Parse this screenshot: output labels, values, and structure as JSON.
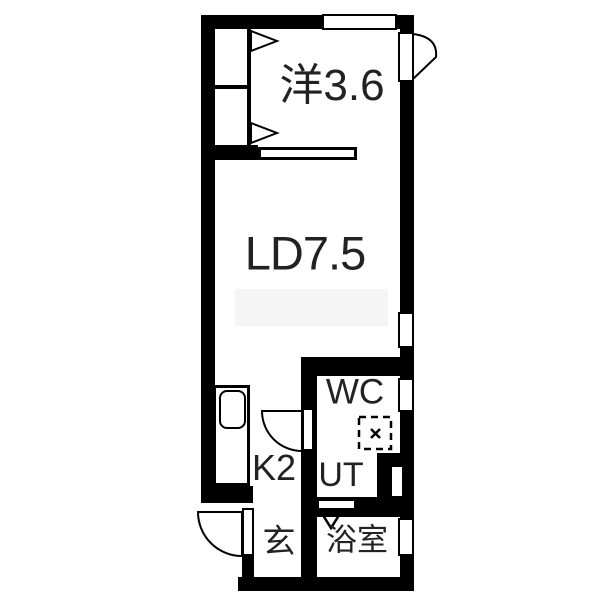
{
  "floorplan": {
    "rooms": [
      {
        "id": "western-room",
        "label": "洋3.6"
      },
      {
        "id": "living-dining",
        "label": "LD7.5"
      },
      {
        "id": "kitchen",
        "label": "K2"
      },
      {
        "id": "toilet",
        "label": "WC"
      },
      {
        "id": "utility",
        "label": "UT"
      },
      {
        "id": "entrance",
        "label": "玄"
      },
      {
        "id": "bathroom",
        "label": "浴室"
      }
    ],
    "symbols": {
      "washing_machine_pan": "dashed square with cross",
      "door_swings": "quarter-circle arcs",
      "closet_doors": "fold triangles",
      "casement_window": "fan at top right"
    },
    "colors": {
      "wall": "#000000",
      "floor": "#ffffff",
      "text": "#222222",
      "watermark": "#f5f5f5"
    }
  }
}
